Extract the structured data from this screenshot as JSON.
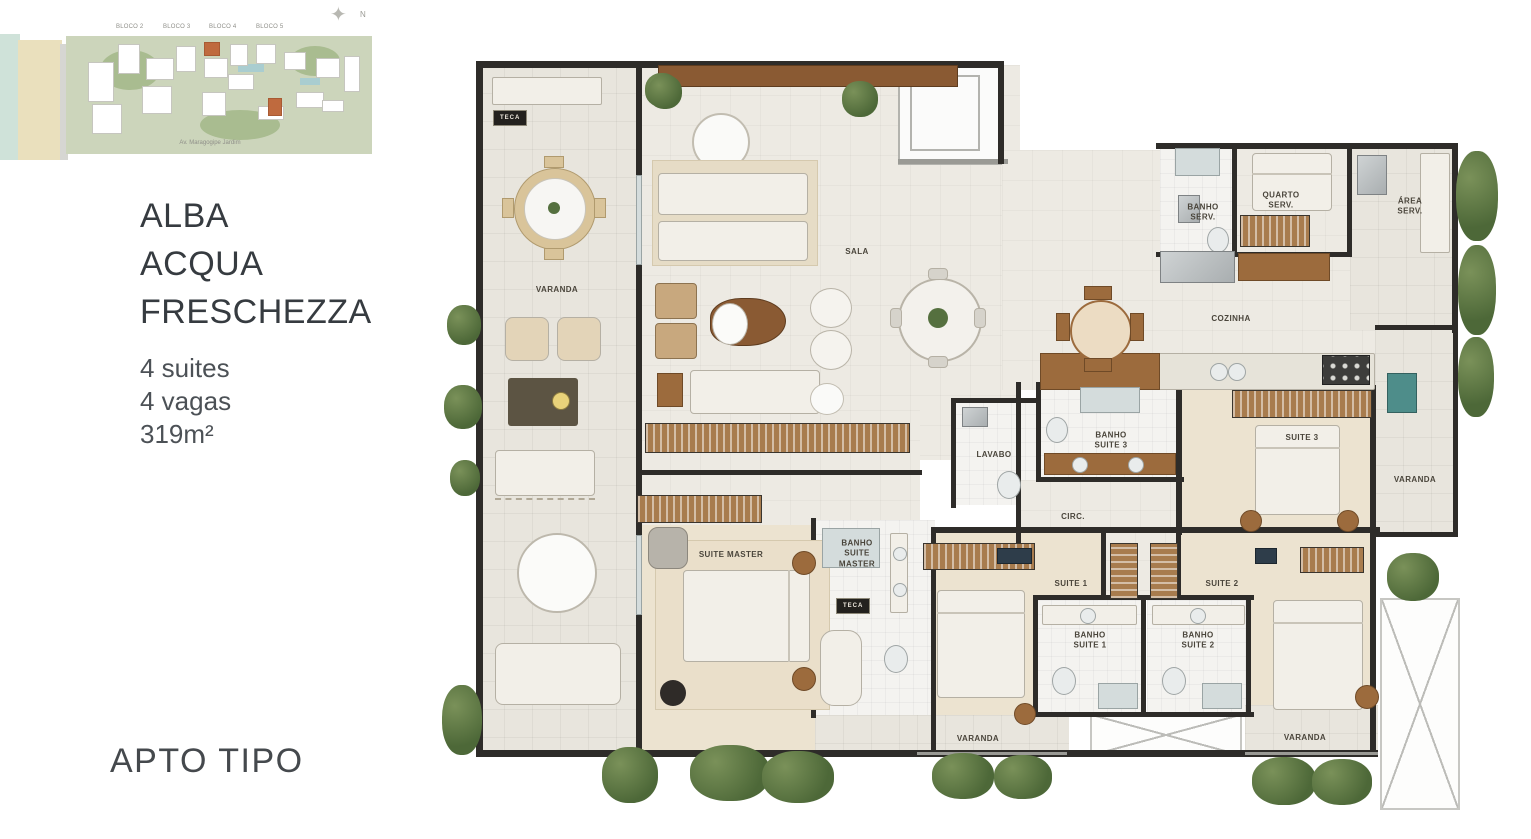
{
  "sidebar": {
    "title_lines": [
      "ALBA",
      "ACQUA",
      "FRESCHEZZA"
    ],
    "specs": [
      "4 suites",
      "4 vagas",
      "319m²"
    ],
    "footer": "APTO TIPO"
  },
  "site_plan": {
    "bloco_labels": [
      "BLOCO 2",
      "BLOCO 3",
      "BLOCO 4",
      "BLOCO 5"
    ],
    "street_label": "Av. Maragogipe Jardim",
    "compass": "N"
  },
  "floor_plan": {
    "teca_label": "TECA",
    "labels": [
      {
        "id": "varanda-left",
        "text": "VARANDA",
        "x": 95,
        "y": 235
      },
      {
        "id": "sala",
        "text": "SALA",
        "x": 395,
        "y": 197
      },
      {
        "id": "banho-serv",
        "text": "BANHO\nSERV.",
        "x": 741,
        "y": 158
      },
      {
        "id": "quarto-serv",
        "text": "QUARTO\nSERV.",
        "x": 819,
        "y": 146
      },
      {
        "id": "area-serv",
        "text": "ÁREA\nSERV.",
        "x": 948,
        "y": 152
      },
      {
        "id": "cozinha",
        "text": "COZINHA",
        "x": 769,
        "y": 264
      },
      {
        "id": "lavabo",
        "text": "LAVABO",
        "x": 532,
        "y": 400
      },
      {
        "id": "banho-suite-3",
        "text": "BANHO\nSUITE 3",
        "x": 649,
        "y": 386
      },
      {
        "id": "circ",
        "text": "CIRC.",
        "x": 611,
        "y": 462
      },
      {
        "id": "suite-3",
        "text": "SUITE 3",
        "x": 840,
        "y": 383
      },
      {
        "id": "varanda-right",
        "text": "VARANDA",
        "x": 953,
        "y": 425
      },
      {
        "id": "suite-master",
        "text": "SUITE MASTER",
        "x": 269,
        "y": 500
      },
      {
        "id": "banho-suite-master",
        "text": "BANHO\nSUITE\nMASTER",
        "x": 395,
        "y": 499
      },
      {
        "id": "suite-1",
        "text": "SUITE 1",
        "x": 609,
        "y": 529
      },
      {
        "id": "suite-2",
        "text": "SUITE 2",
        "x": 760,
        "y": 529
      },
      {
        "id": "banho-suite-1",
        "text": "BANHO\nSUITE 1",
        "x": 628,
        "y": 586
      },
      {
        "id": "banho-suite-2",
        "text": "BANHO\nSUITE 2",
        "x": 736,
        "y": 586
      },
      {
        "id": "varanda-bottom-center",
        "text": "VARANDA",
        "x": 516,
        "y": 684
      },
      {
        "id": "varanda-bottom-right",
        "text": "VARANDA",
        "x": 843,
        "y": 683
      }
    ]
  },
  "colors": {
    "wall": "#2e2c29",
    "wood": "#9c6b3d",
    "plant": "#55703f",
    "floor": "#edeae3",
    "carpet": "#ece3d0",
    "orange_block": "#bf6a3e",
    "water": "#cfe2d9",
    "teal_fixture": "#4e8d8a"
  }
}
